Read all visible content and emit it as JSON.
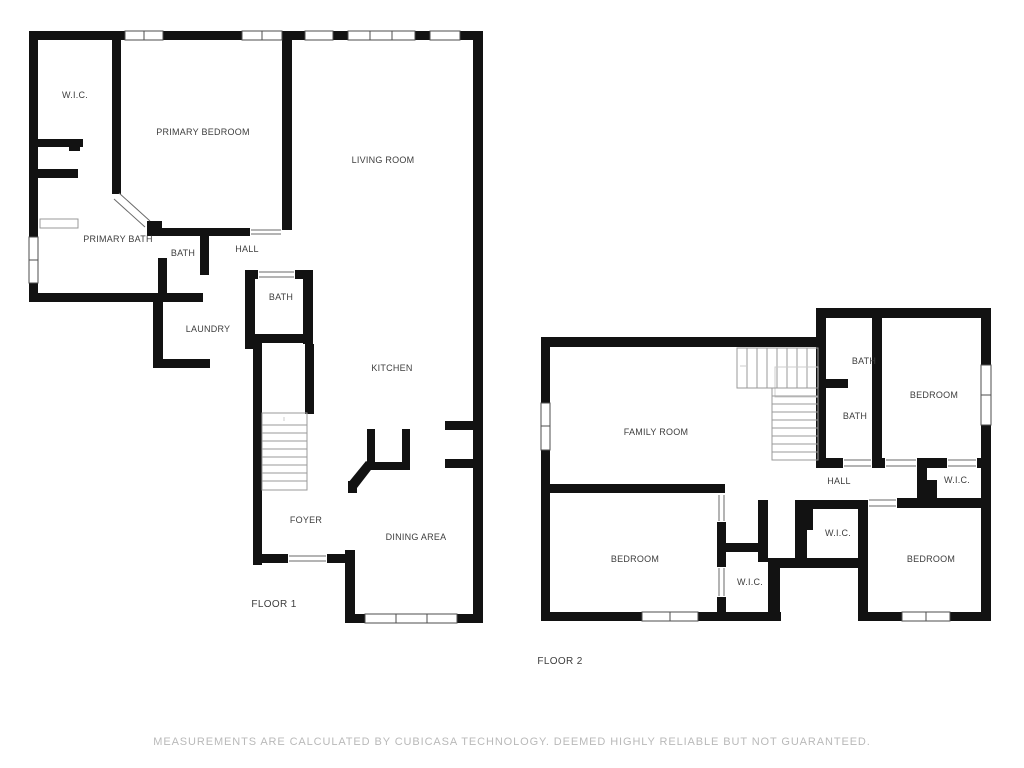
{
  "colors": {
    "background": "#ffffff",
    "wall": "#121212",
    "label": "#3d3d3d",
    "footer": "#b9b9b9"
  },
  "floor1": {
    "title": "FLOOR 1",
    "rooms": [
      {
        "id": "wic",
        "label": "W.I.C."
      },
      {
        "id": "primary-bedroom",
        "label": "PRIMARY BEDROOM"
      },
      {
        "id": "living-room",
        "label": "LIVING ROOM"
      },
      {
        "id": "primary-bath",
        "label": "PRIMARY BATH"
      },
      {
        "id": "bath",
        "label": "BATH"
      },
      {
        "id": "hall",
        "label": "HALL"
      },
      {
        "id": "bath-2",
        "label": "BATH"
      },
      {
        "id": "laundry",
        "label": "LAUNDRY"
      },
      {
        "id": "kitchen",
        "label": "KITCHEN"
      },
      {
        "id": "foyer",
        "label": "FOYER"
      },
      {
        "id": "dining-area",
        "label": "DINING AREA"
      }
    ]
  },
  "floor2": {
    "title": "FLOOR 2",
    "rooms": [
      {
        "id": "family-room",
        "label": "FAMILY ROOM"
      },
      {
        "id": "bath-upper",
        "label": "BATH"
      },
      {
        "id": "bath-lower",
        "label": "BATH"
      },
      {
        "id": "bedroom-top-right",
        "label": "BEDROOM"
      },
      {
        "id": "hall",
        "label": "HALL"
      },
      {
        "id": "wic-right",
        "label": "W.I.C."
      },
      {
        "id": "wic-middle",
        "label": "W.I.C."
      },
      {
        "id": "bedroom-bottom-left",
        "label": "BEDROOM"
      },
      {
        "id": "wic-bottom",
        "label": "W.I.C."
      },
      {
        "id": "bedroom-bottom-right",
        "label": "BEDROOM"
      }
    ]
  },
  "footer": {
    "text": "MEASUREMENTS ARE CALCULATED BY CUBICASA TECHNOLOGY. DEEMED HIGHLY RELIABLE BUT NOT GUARANTEED."
  }
}
